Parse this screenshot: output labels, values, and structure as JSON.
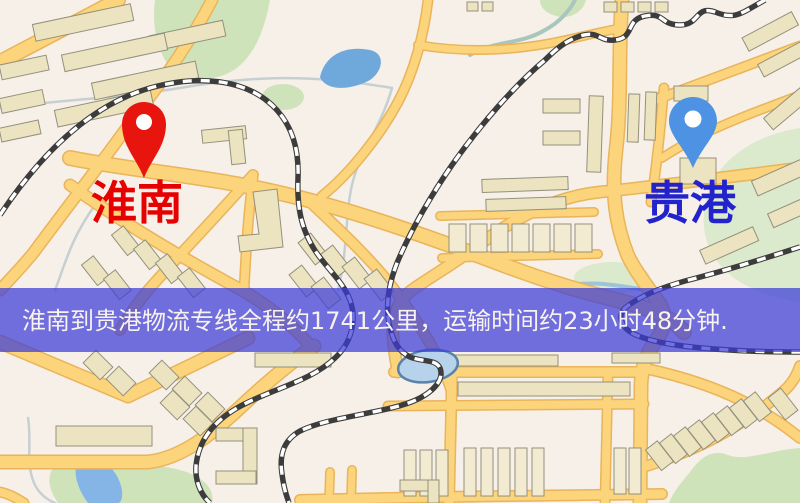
{
  "page": {
    "width": 800,
    "height": 503,
    "kind": "logistics-route-map-image"
  },
  "banner": {
    "text": "淮南到贵港物流专线全程约1741公里，运输时间约23小时48分钟.",
    "background_color": "#3c3cd8",
    "text_color": "#f8f2ee"
  },
  "origin": {
    "label": "淮南",
    "pin_color": "#e8140e",
    "label_color": "#e60000"
  },
  "destination": {
    "label": "贵港",
    "pin_color": "#4e92e4",
    "label_color": "#2323cd"
  },
  "palette": {
    "map_background": "#f7f0e8",
    "road_fill": "#fbd47c",
    "road_casing": "#e9b45a",
    "building_fill": "#ece3c1",
    "building_stroke": "#93907c",
    "water": "#6fa9db",
    "park": "#cfe3bb",
    "railway_dark": "#3c3c3c",
    "railway_light": "#ffffff"
  }
}
